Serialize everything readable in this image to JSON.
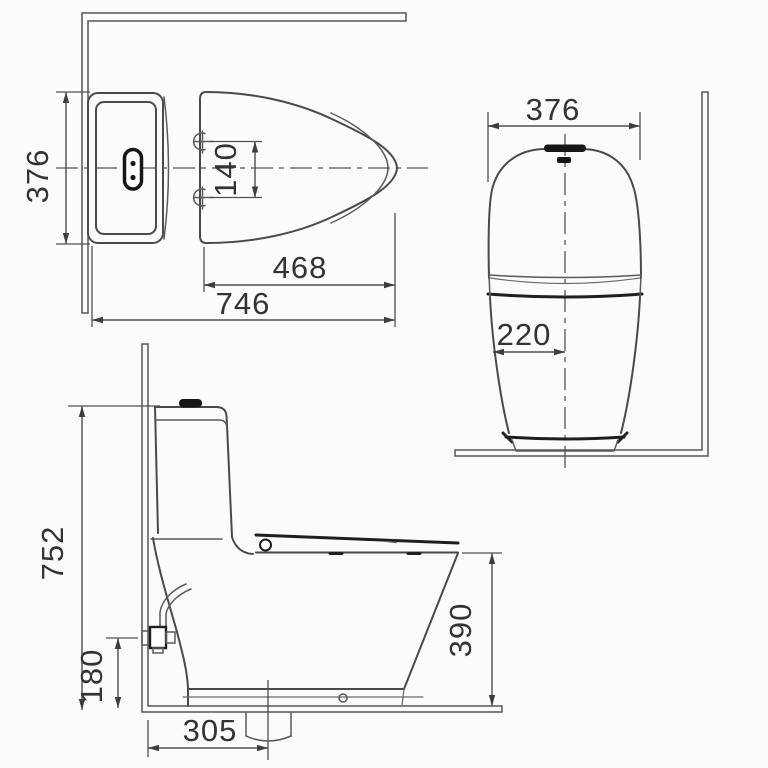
{
  "drawing": {
    "background": "#fbfbfb",
    "colors": {
      "line": "#4a4a4a",
      "dark_accent": "#161616",
      "wall_line": "#565656",
      "dimension_text": "#333333"
    },
    "views": {
      "plan": {
        "dimensions": {
          "overall_width": "376",
          "hinge_bolt_spacing": "140",
          "hinge_to_front": "468",
          "overall_length": "746"
        }
      },
      "front": {
        "dimensions": {
          "tank_width": "376",
          "edge_to_centerline": "220"
        }
      },
      "side": {
        "dimensions": {
          "overall_height": "752",
          "water_inlet_height": "180",
          "rim_height": "390",
          "drain_setout": "305"
        }
      }
    }
  }
}
